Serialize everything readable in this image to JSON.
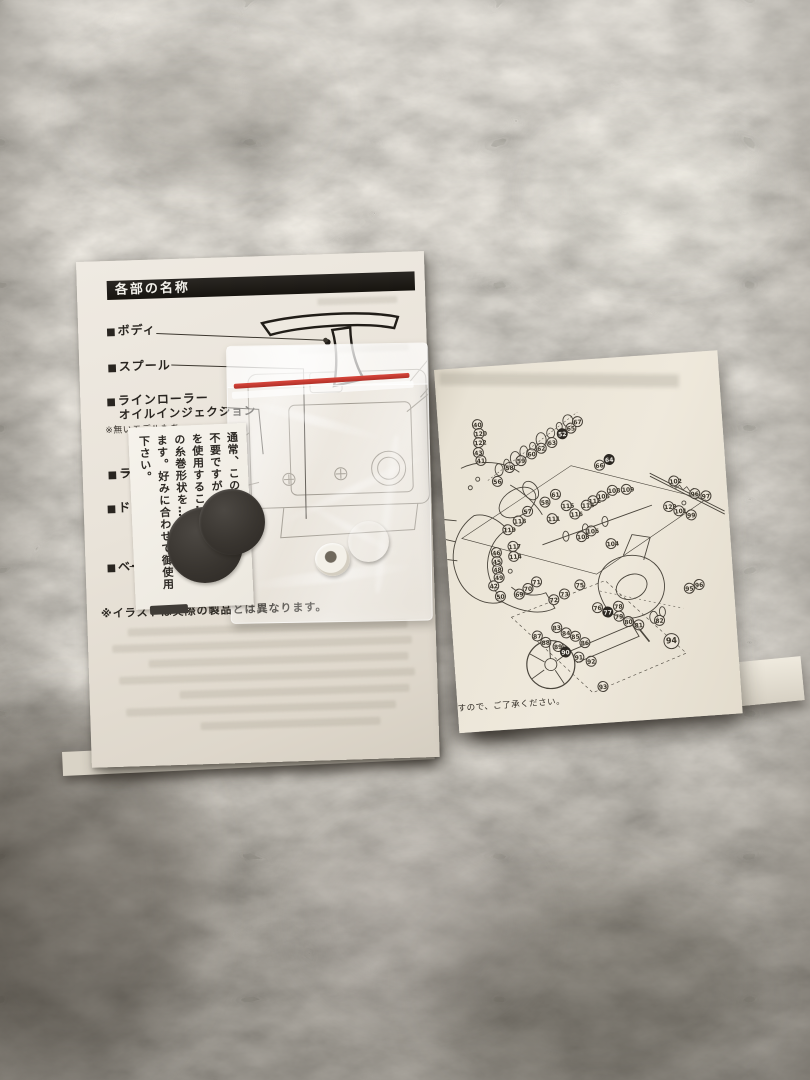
{
  "left_manual": {
    "header": "各部の名称",
    "items": [
      {
        "label": "ボディ"
      },
      {
        "label": "スプール"
      },
      {
        "label": "ラインローラー",
        "label2": "オイルインジェクション",
        "note": "※無いモデルもあ…"
      },
      {
        "label": "ラ…"
      },
      {
        "label": "ド…"
      },
      {
        "label": "ベー…"
      }
    ],
    "footnote": "※イラストは実際の製品とは異なります。"
  },
  "parts_bag": {
    "card_lines": [
      "通常、この調整ワ…は",
      "不要ですが、調…",
      "を使用するこ…",
      "の糸巻形状を…でき",
      "ます。好みに合わせて御使用",
      "下さい。"
    ]
  },
  "right_schematic": {
    "footer_note": "すので、ご了承ください。",
    "callouts": [
      {
        "n": 40,
        "x": 34,
        "y": 52
      },
      {
        "n": 120,
        "x": 35,
        "y": 61
      },
      {
        "n": 122,
        "x": 34,
        "y": 70
      },
      {
        "n": 43,
        "x": 33,
        "y": 80
      },
      {
        "n": 41,
        "x": 35,
        "y": 88
      },
      {
        "n": 56,
        "x": 50,
        "y": 110
      },
      {
        "n": 58,
        "x": 63,
        "y": 97
      },
      {
        "n": 59,
        "x": 75,
        "y": 91
      },
      {
        "n": 60,
        "x": 86,
        "y": 85
      },
      {
        "n": 62,
        "x": 96,
        "y": 80
      },
      {
        "n": 63,
        "x": 107,
        "y": 75
      },
      {
        "n": 52,
        "x": 118,
        "y": 67,
        "k": 1
      },
      {
        "n": 65,
        "x": 127,
        "y": 62
      },
      {
        "n": 67,
        "x": 134,
        "y": 56
      },
      {
        "n": 66,
        "x": 153,
        "y": 101
      },
      {
        "n": 64,
        "x": 163,
        "y": 96,
        "k": 1
      },
      {
        "n": 61,
        "x": 107,
        "y": 127
      },
      {
        "n": 57,
        "x": 78,
        "y": 142
      },
      {
        "n": 58,
        "x": 96,
        "y": 134
      },
      {
        "n": 118,
        "x": 68,
        "y": 151
      },
      {
        "n": 119,
        "x": 57,
        "y": 159
      },
      {
        "n": 112,
        "x": 144,
        "y": 136
      },
      {
        "n": 115,
        "x": 117,
        "y": 139
      },
      {
        "n": 113,
        "x": 137,
        "y": 140
      },
      {
        "n": 116,
        "x": 125,
        "y": 148
      },
      {
        "n": 111,
        "x": 102,
        "y": 151
      },
      {
        "n": 117,
        "x": 61,
        "y": 176
      },
      {
        "n": 114,
        "x": 61,
        "y": 186
      },
      {
        "n": 103,
        "x": 130,
        "y": 171
      },
      {
        "n": 105,
        "x": 140,
        "y": 166
      },
      {
        "n": 104,
        "x": 159,
        "y": 180
      },
      {
        "n": 106,
        "x": 153,
        "y": 132
      },
      {
        "n": 108,
        "x": 164,
        "y": 127
      },
      {
        "n": 109,
        "x": 178,
        "y": 127
      },
      {
        "n": 102,
        "x": 226,
        "y": 122
      },
      {
        "n": 96,
        "x": 246,
        "y": 136
      },
      {
        "n": 97,
        "x": 257,
        "y": 139
      },
      {
        "n": 123,
        "x": 219,
        "y": 147
      },
      {
        "n": 101,
        "x": 229,
        "y": 152
      },
      {
        "n": 99,
        "x": 241,
        "y": 157
      },
      {
        "n": 46,
        "x": 44,
        "y": 181
      },
      {
        "n": 45,
        "x": 44,
        "y": 190
      },
      {
        "n": 48,
        "x": 44,
        "y": 198
      },
      {
        "n": 49,
        "x": 45,
        "y": 206
      },
      {
        "n": 42,
        "x": 39,
        "y": 214
      },
      {
        "n": 50,
        "x": 45,
        "y": 225
      },
      {
        "n": 69,
        "x": 64,
        "y": 224
      },
      {
        "n": 70,
        "x": 73,
        "y": 219
      },
      {
        "n": 71,
        "x": 82,
        "y": 213
      },
      {
        "n": 72,
        "x": 98,
        "y": 232
      },
      {
        "n": 73,
        "x": 109,
        "y": 227
      },
      {
        "n": 75,
        "x": 125,
        "y": 219
      },
      {
        "n": 76,
        "x": 141,
        "y": 243
      },
      {
        "n": 77,
        "x": 151,
        "y": 248,
        "k": 1
      },
      {
        "n": 78,
        "x": 162,
        "y": 243
      },
      {
        "n": 79,
        "x": 162,
        "y": 253
      },
      {
        "n": 80,
        "x": 171,
        "y": 259
      },
      {
        "n": 81,
        "x": 181,
        "y": 263
      },
      {
        "n": 82,
        "x": 202,
        "y": 260
      },
      {
        "n": 94,
        "x": 210,
        "y": 279,
        "l": 1
      },
      {
        "n": 95,
        "x": 234,
        "y": 230
      },
      {
        "n": 96,
        "x": 244,
        "y": 227
      },
      {
        "n": 83,
        "x": 99,
        "y": 260
      },
      {
        "n": 84,
        "x": 108,
        "y": 266
      },
      {
        "n": 85,
        "x": 117,
        "y": 270
      },
      {
        "n": 86,
        "x": 126,
        "y": 277
      },
      {
        "n": 87,
        "x": 79,
        "y": 267
      },
      {
        "n": 88,
        "x": 87,
        "y": 274
      },
      {
        "n": 89,
        "x": 99,
        "y": 279
      },
      {
        "n": 90,
        "x": 106,
        "y": 285,
        "k": 1
      },
      {
        "n": 91,
        "x": 119,
        "y": 291
      },
      {
        "n": 92,
        "x": 131,
        "y": 296
      },
      {
        "n": 93,
        "x": 141,
        "y": 322
      }
    ]
  },
  "colors": {
    "carpet": "#9a948a",
    "page_left": "#e9e3d9",
    "page_right": "#e9e3d5",
    "ink": "#2c2822",
    "seal_red": "#c23a32",
    "bearing_brown": "#6e3a28",
    "washer_dark": "#393530"
  }
}
